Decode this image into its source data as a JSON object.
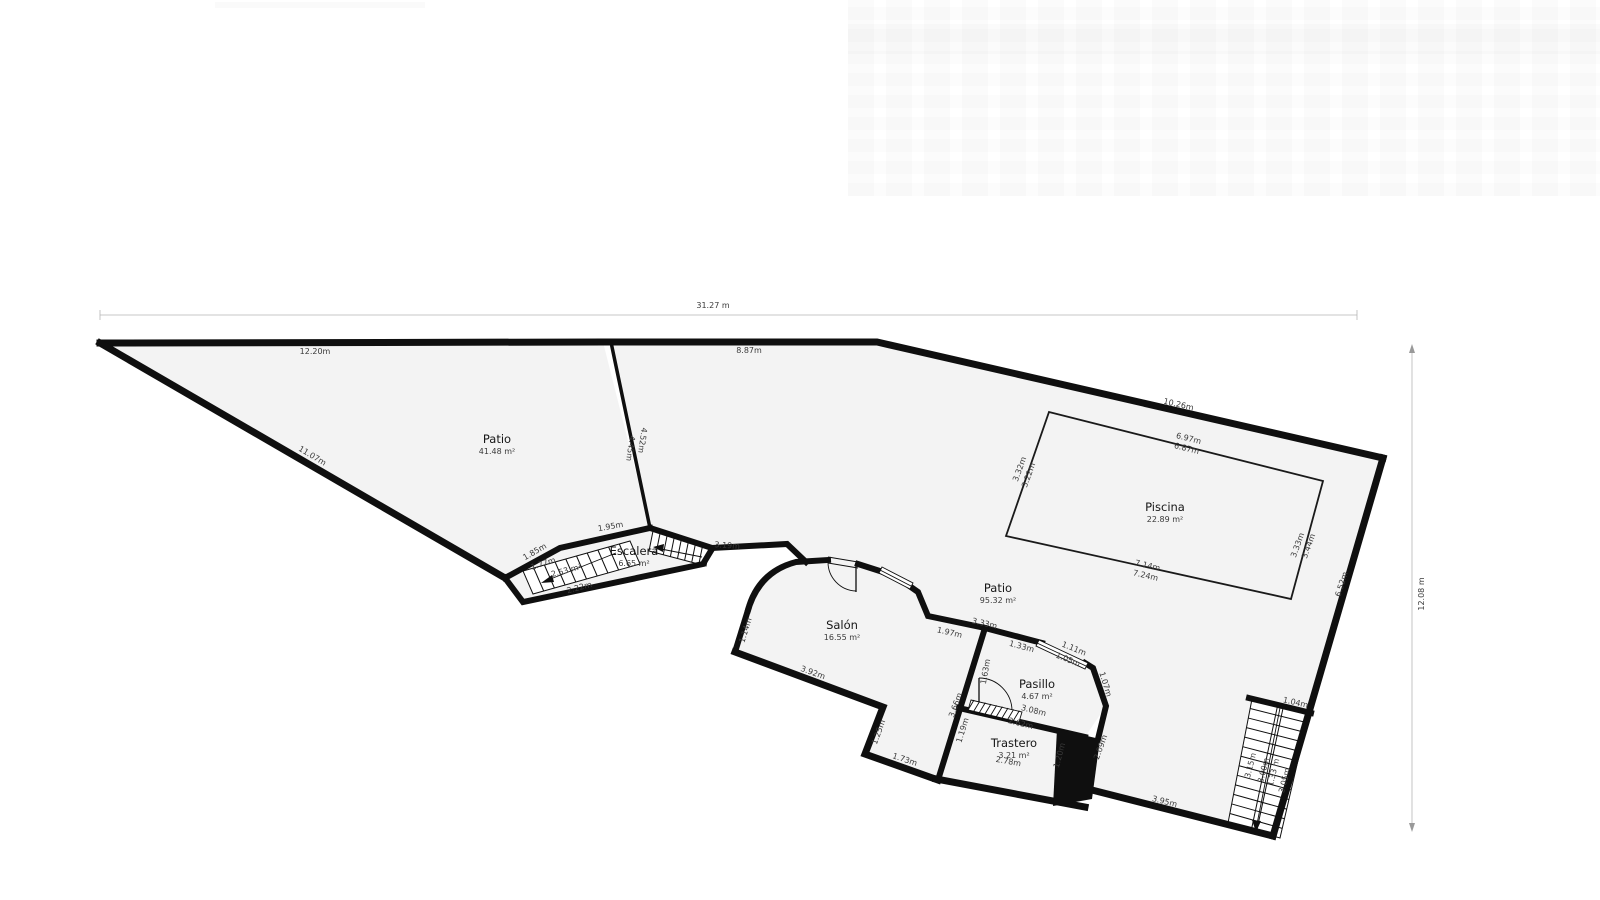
{
  "colors": {
    "wall": "#0f0f0f",
    "floor": "#f3f3f3",
    "stair_fill": "#ffffff",
    "dim_text": "#3a3a3a",
    "dim_line": "#b5b5b5",
    "room_text": "#161616",
    "pool_stroke": "#1a1a1a"
  },
  "overall_dimensions": {
    "width_label": "31.27 m",
    "height_label": "12.08 m"
  },
  "rooms": [
    {
      "name": "Patio",
      "area": "41.48 m²",
      "x": 497,
      "y": 443
    },
    {
      "name": "Patio",
      "area": "95.32 m²",
      "x": 998,
      "y": 592
    },
    {
      "name": "Piscina",
      "area": "22.89 m²",
      "x": 1165,
      "y": 511
    },
    {
      "name": "Salón",
      "area": "16.55 m²",
      "x": 842,
      "y": 629
    },
    {
      "name": "Escalera",
      "area": "6.65 m²",
      "x": 634,
      "y": 555
    },
    {
      "name": "Pasillo",
      "area": "4.67 m²",
      "x": 1037,
      "y": 688
    },
    {
      "name": "Trastero",
      "area": "3.21 m²",
      "x": 1014,
      "y": 747
    }
  ],
  "dimensions": [
    {
      "text": "31.27 m",
      "x": 713,
      "y": 308,
      "rot": 0
    },
    {
      "text": "12.08 m",
      "x": 1424,
      "y": 594,
      "rot": -90
    },
    {
      "text": "12.20m",
      "x": 315,
      "y": 354,
      "rot": 0
    },
    {
      "text": "8.87m",
      "x": 749,
      "y": 353,
      "rot": 0
    },
    {
      "text": "10.26m",
      "x": 1178,
      "y": 407,
      "rot": 13
    },
    {
      "text": "11.07m",
      "x": 311,
      "y": 458,
      "rot": 31
    },
    {
      "text": "4.45m",
      "x": 628,
      "y": 448,
      "rot": 98
    },
    {
      "text": "4.52m",
      "x": 640,
      "y": 440,
      "rot": 98
    },
    {
      "text": "1.95m",
      "x": 611,
      "y": 529,
      "rot": -10
    },
    {
      "text": "1.85m",
      "x": 536,
      "y": 554,
      "rot": -30
    },
    {
      "text": "1.77m",
      "x": 544,
      "y": 566,
      "rot": -18
    },
    {
      "text": "2.53 m²",
      "x": 567,
      "y": 573,
      "rot": -15
    },
    {
      "text": "2.22m",
      "x": 580,
      "y": 590,
      "rot": -15
    },
    {
      "text": "3.19m",
      "x": 727,
      "y": 548,
      "rot": 4
    },
    {
      "text": "6.97m",
      "x": 1188,
      "y": 441,
      "rot": 14
    },
    {
      "text": "6.87m",
      "x": 1186,
      "y": 451,
      "rot": 14
    },
    {
      "text": "3.32m",
      "x": 1022,
      "y": 470,
      "rot": -70
    },
    {
      "text": "3.22m",
      "x": 1031,
      "y": 476,
      "rot": -70
    },
    {
      "text": "3.33m",
      "x": 1300,
      "y": 546,
      "rot": -70
    },
    {
      "text": "3.44m",
      "x": 1311,
      "y": 547,
      "rot": -70
    },
    {
      "text": "7.14m",
      "x": 1147,
      "y": 568,
      "rot": 13
    },
    {
      "text": "7.24m",
      "x": 1145,
      "y": 578,
      "rot": 13
    },
    {
      "text": "6.52m",
      "x": 1344,
      "y": 585,
      "rot": -73
    },
    {
      "text": "1.14m",
      "x": 748,
      "y": 631,
      "rot": -73
    },
    {
      "text": "3.92m",
      "x": 812,
      "y": 675,
      "rot": 20
    },
    {
      "text": "1.25m",
      "x": 881,
      "y": 733,
      "rot": -70
    },
    {
      "text": "1.73m",
      "x": 904,
      "y": 762,
      "rot": 18
    },
    {
      "text": "3.33m",
      "x": 984,
      "y": 626,
      "rot": 13
    },
    {
      "text": "1.97m",
      "x": 949,
      "y": 635,
      "rot": 13
    },
    {
      "text": "1.33m",
      "x": 1021,
      "y": 649,
      "rot": 15
    },
    {
      "text": "1.11m",
      "x": 1073,
      "y": 651,
      "rot": 22
    },
    {
      "text": "1.05m",
      "x": 1067,
      "y": 662,
      "rot": 22
    },
    {
      "text": "1.07m",
      "x": 1103,
      "y": 685,
      "rot": 73
    },
    {
      "text": "1.63m",
      "x": 988,
      "y": 672,
      "rot": -80
    },
    {
      "text": "3.66m",
      "x": 958,
      "y": 706,
      "rot": -70
    },
    {
      "text": "3.08m",
      "x": 1033,
      "y": 713,
      "rot": 14
    },
    {
      "text": "2.62m",
      "x": 1020,
      "y": 726,
      "rot": 14
    },
    {
      "text": "1.19m",
      "x": 965,
      "y": 731,
      "rot": -73
    },
    {
      "text": "2.78m",
      "x": 1008,
      "y": 764,
      "rot": 10
    },
    {
      "text": "1.20m",
      "x": 1062,
      "y": 756,
      "rot": -75
    },
    {
      "text": "2.09m",
      "x": 1103,
      "y": 748,
      "rot": -70
    },
    {
      "text": "3.95m",
      "x": 1164,
      "y": 804,
      "rot": 14
    },
    {
      "text": "1.04m",
      "x": 1295,
      "y": 705,
      "rot": 13
    },
    {
      "text": "3.15m",
      "x": 1253,
      "y": 766,
      "rot": -76
    },
    {
      "text": "3.00m",
      "x": 1266,
      "y": 771,
      "rot": -76
    },
    {
      "text": "1.33 m",
      "x": 1276,
      "y": 773,
      "rot": -76
    },
    {
      "text": "3.05m",
      "x": 1287,
      "y": 781,
      "rot": -76
    }
  ]
}
